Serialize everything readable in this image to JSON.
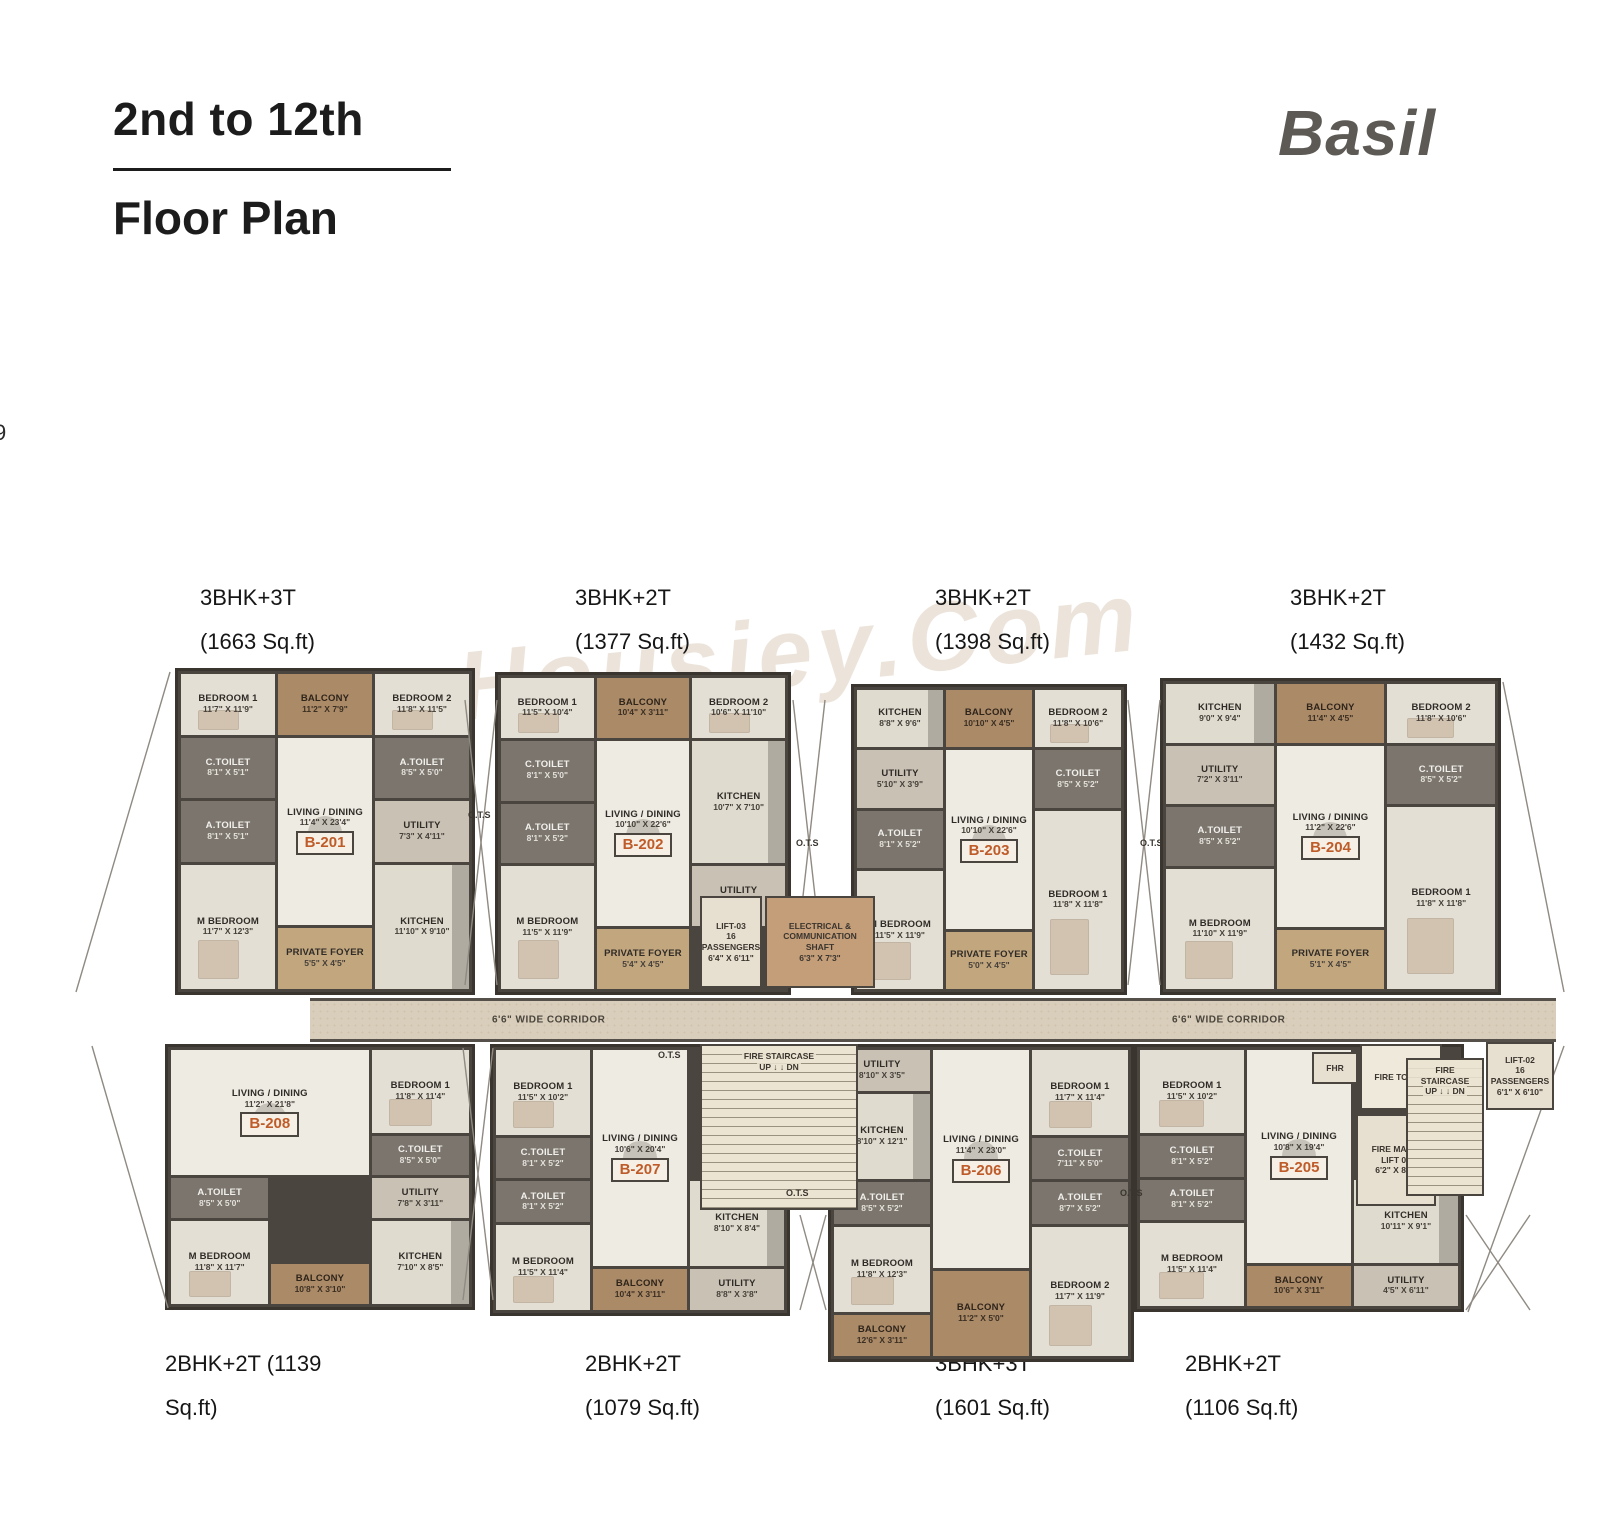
{
  "page": {
    "title_line1": "2nd to 12th",
    "title_line2": "Floor Plan",
    "brand": "Basil",
    "page_number": "9",
    "watermark": "Housiey.Com"
  },
  "corridor": {
    "label": "6'6\" WIDE CORRIDOR"
  },
  "top_labels": [
    {
      "line1": "3BHK+3T",
      "line2": "(1663 Sq.ft)",
      "x": 200
    },
    {
      "line1": "3BHK+2T",
      "line2": "(1377 Sq.ft)",
      "x": 575
    },
    {
      "line1": "3BHK+2T",
      "line2": "(1398 Sq.ft)",
      "x": 935
    },
    {
      "line1": "3BHK+2T",
      "line2": "(1432 Sq.ft)",
      "x": 1290
    }
  ],
  "bottom_labels": [
    {
      "line1": "2BHK+2T (1139",
      "line2": "Sq.ft)",
      "x": 165
    },
    {
      "line1": "2BHK+2T",
      "line2": "(1079 Sq.ft)",
      "x": 585
    },
    {
      "line1": "3BHK+3T",
      "line2": "(1601 Sq.ft)",
      "x": 935
    },
    {
      "line1": "2BHK+2T",
      "line2": "(1106 Sq.ft)",
      "x": 1185
    }
  ],
  "units": [
    {
      "id": "B-201",
      "box": [
        175,
        668,
        300,
        327
      ],
      "rows": 5,
      "rooms": [
        {
          "label": "BEDROOM 1",
          "dims": "11'7\" X 11'9\"",
          "kind": "bedroom",
          "area": "1/1/2/2"
        },
        {
          "label": "BALCONY",
          "dims": "11'2\" X 7'9\"",
          "kind": "balcony",
          "area": "1/2/2/3"
        },
        {
          "label": "BEDROOM 2",
          "dims": "11'8\" X 11'5\"",
          "kind": "bedroom",
          "area": "1/3/2/4"
        },
        {
          "label": "C.TOILET",
          "dims": "8'1\" X 5'1\"",
          "kind": "toilet",
          "area": "2/1/3/2"
        },
        {
          "label": "LIVING / DINING",
          "dims": "11'4\" X 23'4\"",
          "kind": "living",
          "area": "2/2/5/3",
          "badge": "B-201"
        },
        {
          "label": "A.TOILET",
          "dims": "8'5\" X 5'0\"",
          "kind": "toilet",
          "area": "2/3/3/4"
        },
        {
          "label": "A.TOILET",
          "dims": "8'1\" X 5'1\"",
          "kind": "toilet",
          "area": "3/1/4/2"
        },
        {
          "label": "UTILITY",
          "dims": "7'3\" X 4'11\"",
          "kind": "utility",
          "area": "3/3/4/4"
        },
        {
          "label": "M BEDROOM",
          "dims": "11'7\" X 12'3\"",
          "kind": "bedroom",
          "area": "4/1/6/2"
        },
        {
          "label": "KITCHEN",
          "dims": "11'10\" X 9'10\"",
          "kind": "kitchen",
          "area": "4/3/6/4"
        },
        {
          "label": "PRIVATE FOYER",
          "dims": "5'5\" X 4'5\"",
          "kind": "foyer",
          "area": "5/2/6/3"
        }
      ]
    },
    {
      "id": "B-202",
      "box": [
        495,
        672,
        296,
        323
      ],
      "rows": 5,
      "rooms": [
        {
          "label": "BEDROOM 1",
          "dims": "11'5\" X 10'4\"",
          "kind": "bedroom",
          "area": "1/1/2/2"
        },
        {
          "label": "BALCONY",
          "dims": "10'4\" X 3'11\"",
          "kind": "balcony",
          "area": "1/2/2/3"
        },
        {
          "label": "BEDROOM 2",
          "dims": "10'6\" X 11'10\"",
          "kind": "bedroom",
          "area": "1/3/2/4"
        },
        {
          "label": "C.TOILET",
          "dims": "8'1\" X 5'0\"",
          "kind": "toilet",
          "area": "2/1/3/2"
        },
        {
          "label": "LIVING / DINING",
          "dims": "10'10\" X 22'6\"",
          "kind": "living",
          "area": "2/2/5/3",
          "badge": "B-202"
        },
        {
          "label": "KITCHEN",
          "dims": "10'7\" X 7'10\"",
          "kind": "kitchen",
          "area": "2/3/4/4"
        },
        {
          "label": "A.TOILET",
          "dims": "8'1\" X 5'2\"",
          "kind": "toilet",
          "area": "3/1/4/2"
        },
        {
          "label": "UTILITY",
          "dims": "8'5\" X 3'9\"",
          "kind": "utility",
          "area": "4/3/5/4"
        },
        {
          "label": "M BEDROOM",
          "dims": "11'5\" X 11'9\"",
          "kind": "bedroom",
          "area": "4/1/6/2"
        },
        {
          "label": "PRIVATE FOYER",
          "dims": "5'4\" X 4'5\"",
          "kind": "foyer",
          "area": "5/2/6/3"
        }
      ]
    },
    {
      "id": "B-203",
      "box": [
        851,
        684,
        276,
        311
      ],
      "rows": 5,
      "rooms": [
        {
          "label": "KITCHEN",
          "dims": "8'8\" X 9'6\"",
          "kind": "kitchen",
          "area": "1/1/2/2"
        },
        {
          "label": "BALCONY",
          "dims": "10'10\" X 4'5\"",
          "kind": "balcony",
          "area": "1/2/2/3"
        },
        {
          "label": "BEDROOM 2",
          "dims": "11'8\" X 10'6\"",
          "kind": "bedroom",
          "area": "1/3/2/4"
        },
        {
          "label": "UTILITY",
          "dims": "5'10\" X 3'9\"",
          "kind": "utility",
          "area": "2/1/3/2"
        },
        {
          "label": "LIVING / DINING",
          "dims": "10'10\" X 22'6\"",
          "kind": "living",
          "area": "2/2/5/3",
          "badge": "B-203"
        },
        {
          "label": "C.TOILET",
          "dims": "8'5\" X 5'2\"",
          "kind": "toilet",
          "area": "2/3/3/4"
        },
        {
          "label": "A.TOILET",
          "dims": "8'1\" X 5'2\"",
          "kind": "toilet",
          "area": "3/1/4/2"
        },
        {
          "label": "BEDROOM 1",
          "dims": "11'8\" X 11'8\"",
          "kind": "bedroom",
          "area": "3/3/6/4"
        },
        {
          "label": "M BEDROOM",
          "dims": "11'5\" X 11'9\"",
          "kind": "bedroom",
          "area": "4/1/6/2"
        },
        {
          "label": "PRIVATE FOYER",
          "dims": "5'0\" X 4'5\"",
          "kind": "foyer",
          "area": "5/2/6/3"
        }
      ]
    },
    {
      "id": "B-204",
      "box": [
        1160,
        678,
        341,
        317
      ],
      "rows": 5,
      "rooms": [
        {
          "label": "KITCHEN",
          "dims": "9'0\" X 9'4\"",
          "kind": "kitchen",
          "area": "1/1/2/2"
        },
        {
          "label": "BALCONY",
          "dims": "11'4\" X 4'5\"",
          "kind": "balcony",
          "area": "1/2/2/3"
        },
        {
          "label": "BEDROOM 2",
          "dims": "11'8\" X 10'6\"",
          "kind": "bedroom",
          "area": "1/3/2/4"
        },
        {
          "label": "UTILITY",
          "dims": "7'2\" X 3'11\"",
          "kind": "utility",
          "area": "2/1/3/2"
        },
        {
          "label": "LIVING / DINING",
          "dims": "11'2\" X 22'6\"",
          "kind": "living",
          "area": "2/2/5/3",
          "badge": "B-204"
        },
        {
          "label": "C.TOILET",
          "dims": "8'5\" X 5'2\"",
          "kind": "toilet",
          "area": "2/3/3/4"
        },
        {
          "label": "A.TOILET",
          "dims": "8'5\" X 5'2\"",
          "kind": "toilet",
          "area": "3/1/4/2"
        },
        {
          "label": "BEDROOM 1",
          "dims": "11'8\" X 11'8\"",
          "kind": "bedroom",
          "area": "3/3/6/4"
        },
        {
          "label": "M BEDROOM",
          "dims": "11'10\" X 11'9\"",
          "kind": "bedroom",
          "area": "4/1/6/2"
        },
        {
          "label": "PRIVATE FOYER",
          "dims": "5'1\" X 4'5\"",
          "kind": "foyer",
          "area": "5/2/6/3"
        }
      ]
    },
    {
      "id": "B-208",
      "box": [
        165,
        1044,
        310,
        266
      ],
      "rows": 6,
      "rooms": [
        {
          "label": "LIVING / DINING",
          "dims": "11'2\" X 21'8\"",
          "kind": "living",
          "area": "1/1/4/3",
          "badge": "B-208"
        },
        {
          "label": "BEDROOM 1",
          "dims": "11'8\" X 11'4\"",
          "kind": "bedroom",
          "area": "1/3/3/4"
        },
        {
          "label": "C.TOILET",
          "dims": "8'5\" X 5'0\"",
          "kind": "toilet",
          "area": "3/3/4/4"
        },
        {
          "label": "A.TOILET",
          "dims": "8'5\" X 5'0\"",
          "kind": "toilet",
          "area": "4/1/5/2"
        },
        {
          "label": "UTILITY",
          "dims": "7'8\" X 3'11\"",
          "kind": "utility",
          "area": "4/3/5/4"
        },
        {
          "label": "M BEDROOM",
          "dims": "11'8\" X 11'7\"",
          "kind": "bedroom",
          "area": "5/1/7/2"
        },
        {
          "label": "KITCHEN",
          "dims": "7'10\" X 8'5\"",
          "kind": "kitchen",
          "area": "5/3/7/4"
        },
        {
          "label": "BALCONY",
          "dims": "10'8\" X 3'10\"",
          "kind": "balcony",
          "area": "6/2/7/3"
        }
      ]
    },
    {
      "id": "B-207",
      "box": [
        490,
        1044,
        300,
        272
      ],
      "rows": 6,
      "rooms": [
        {
          "label": "BEDROOM 1",
          "dims": "11'5\" X 10'2\"",
          "kind": "bedroom",
          "area": "1/1/3/2"
        },
        {
          "label": "LIVING / DINING",
          "dims": "10'6\" X 20'4\"",
          "kind": "living",
          "area": "1/2/6/3",
          "badge": "B-207"
        },
        {
          "label": "C.TOILET",
          "dims": "8'1\" X 5'2\"",
          "kind": "toilet",
          "area": "3/1/4/2"
        },
        {
          "label": "A.TOILET",
          "dims": "8'1\" X 5'2\"",
          "kind": "toilet",
          "area": "4/1/5/2"
        },
        {
          "label": "KITCHEN",
          "dims": "8'10\" X 8'4\"",
          "kind": "kitchen",
          "area": "4/3/6/4"
        },
        {
          "label": "M BEDROOM",
          "dims": "11'5\" X 11'4\"",
          "kind": "bedroom",
          "area": "5/1/7/2"
        },
        {
          "label": "BALCONY",
          "dims": "10'4\" X 3'11\"",
          "kind": "balcony",
          "area": "6/2/7/3"
        },
        {
          "label": "UTILITY",
          "dims": "8'8\" X 3'8\"",
          "kind": "utility",
          "area": "6/3/7/4"
        }
      ]
    },
    {
      "id": "B-206",
      "box": [
        828,
        1044,
        306,
        318
      ],
      "rows": 7,
      "rooms": [
        {
          "label": "UTILITY",
          "dims": "8'10\" X 3'5\"",
          "kind": "utility",
          "area": "1/1/2/2"
        },
        {
          "label": "LIVING / DINING",
          "dims": "11'4\" X 23'0\"",
          "kind": "living",
          "area": "1/2/6/3",
          "badge": "B-206"
        },
        {
          "label": "BEDROOM 1",
          "dims": "11'7\" X 11'4\"",
          "kind": "bedroom",
          "area": "1/3/3/4"
        },
        {
          "label": "KITCHEN",
          "dims": "8'10\" X 12'1\"",
          "kind": "kitchen",
          "area": "2/1/4/2"
        },
        {
          "label": "C.TOILET",
          "dims": "7'11\" X 5'0\"",
          "kind": "toilet",
          "area": "3/3/4/4"
        },
        {
          "label": "A.TOILET",
          "dims": "8'5\" X 5'2\"",
          "kind": "toilet",
          "area": "4/1/5/2"
        },
        {
          "label": "A.TOILET",
          "dims": "8'7\" X 5'2\"",
          "kind": "toilet",
          "area": "4/3/5/4"
        },
        {
          "label": "M BEDROOM",
          "dims": "11'8\" X 12'3\"",
          "kind": "bedroom",
          "area": "5/1/7/2"
        },
        {
          "label": "BEDROOM 2",
          "dims": "11'7\" X 11'9\"",
          "kind": "bedroom",
          "area": "5/3/8/4"
        },
        {
          "label": "BALCONY",
          "dims": "11'2\" X 5'0\"",
          "kind": "balcony",
          "area": "6/2/8/3"
        },
        {
          "label": "BALCONY",
          "dims": "12'6\" X 3'11\"",
          "kind": "balcony",
          "area": "7/1/8/2"
        }
      ]
    },
    {
      "id": "B-205",
      "box": [
        1134,
        1044,
        330,
        268
      ],
      "rows": 6,
      "rooms": [
        {
          "label": "BEDROOM 1",
          "dims": "11'5\" X 10'2\"",
          "kind": "bedroom",
          "area": "1/1/3/2"
        },
        {
          "label": "LIVING / DINING",
          "dims": "10'8\" X 19'4\"",
          "kind": "living",
          "area": "1/2/6/3",
          "badge": "B-205"
        },
        {
          "label": "C.TOILET",
          "dims": "8'1\" X 5'2\"",
          "kind": "toilet",
          "area": "3/1/4/2"
        },
        {
          "label": "A.TOILET",
          "dims": "8'1\" X 5'2\"",
          "kind": "toilet",
          "area": "4/1/5/2"
        },
        {
          "label": "KITCHEN",
          "dims": "10'11\" X 9'1\"",
          "kind": "kitchen",
          "area": "4/3/6/4"
        },
        {
          "label": "M BEDROOM",
          "dims": "11'5\" X 11'4\"",
          "kind": "bedroom",
          "area": "5/1/7/2"
        },
        {
          "label": "BALCONY",
          "dims": "10'6\" X 3'11\"",
          "kind": "balcony",
          "area": "6/2/7/3"
        },
        {
          "label": "UTILITY",
          "dims": "4'5\" X 6'11\"",
          "kind": "utility",
          "area": "6/3/7/4"
        }
      ]
    }
  ],
  "facilities": [
    {
      "id": "lift-03",
      "kind": "lift",
      "box": [
        700,
        896,
        62,
        92
      ],
      "lines": [
        "LIFT-03",
        "16 PASSENGERS",
        "6'4\" X 6'11\""
      ]
    },
    {
      "id": "electrical-shaft",
      "kind": "shaft",
      "box": [
        765,
        896,
        110,
        92
      ],
      "lines": [
        "ELECTRICAL &",
        "COMMUNICATION",
        "SHAFT",
        "6'3\" X 7'3\""
      ]
    },
    {
      "id": "fire-staircase-left",
      "kind": "stair",
      "box": [
        700,
        1044,
        158,
        166
      ],
      "lines": [
        "FIRE STAIRCASE",
        "UP ↓   ↓ DN"
      ]
    },
    {
      "id": "fhr",
      "kind": "lift",
      "box": [
        1312,
        1052,
        46,
        32
      ],
      "lines": [
        "FHR"
      ]
    },
    {
      "id": "fire-tower",
      "kind": "tower",
      "box": [
        1360,
        1044,
        82,
        66
      ],
      "lines": [
        "FIRE TOWER"
      ]
    },
    {
      "id": "fire-mans-lift",
      "kind": "lift",
      "box": [
        1356,
        1114,
        80,
        92
      ],
      "lines": [
        "FIRE MAN'S",
        "LIFT 04",
        "6'2\" X 8'1\""
      ]
    },
    {
      "id": "fire-staircase-right",
      "kind": "stair",
      "box": [
        1406,
        1058,
        78,
        138
      ],
      "lines": [
        "FIRE STAIRCASE",
        "UP ↓   ↓ DN"
      ]
    },
    {
      "id": "lift-02",
      "kind": "lift",
      "box": [
        1486,
        1042,
        68,
        68
      ],
      "lines": [
        "LIFT-02",
        "16 PASSENGERS",
        "6'1\" X 6'10\""
      ]
    }
  ],
  "ots_labels": [
    {
      "text": "O.T.S",
      "x": 468,
      "y": 810
    },
    {
      "text": "O.T.S",
      "x": 796,
      "y": 838
    },
    {
      "text": "O.T.S",
      "x": 1140,
      "y": 838
    },
    {
      "text": "O.T.S",
      "x": 658,
      "y": 1050
    },
    {
      "text": "O.T.S",
      "x": 786,
      "y": 1188
    },
    {
      "text": "O.T.S",
      "x": 1120,
      "y": 1188
    }
  ]
}
